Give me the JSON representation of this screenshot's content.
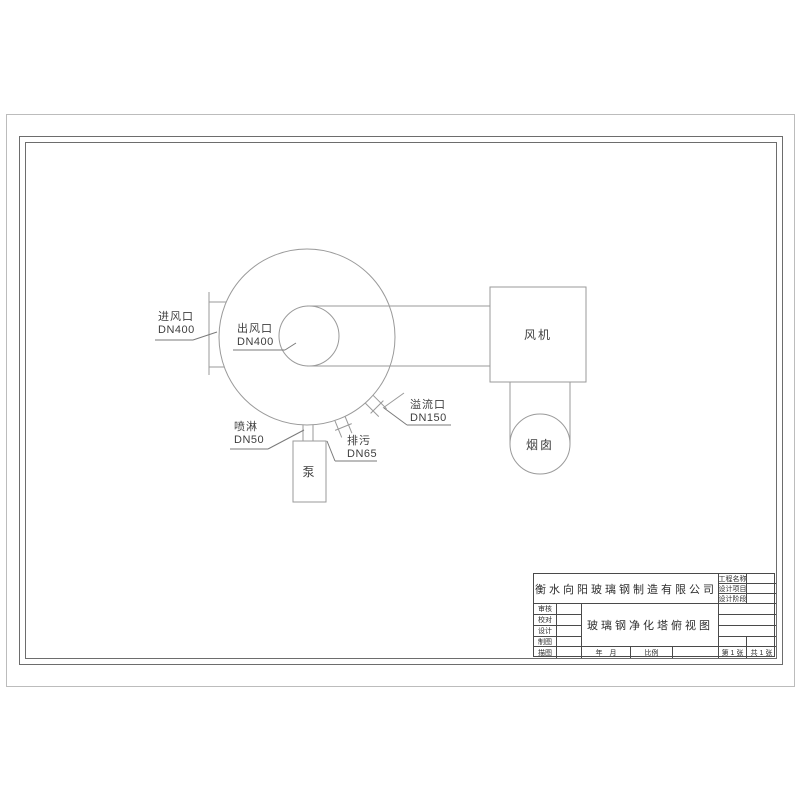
{
  "diagram": {
    "inlet_label": "进风口",
    "inlet_dn": "DN400",
    "outlet_label": "出风口",
    "outlet_dn": "DN400",
    "spray_label": "喷淋",
    "spray_dn": "DN50",
    "drain_label": "排污",
    "drain_dn": "DN65",
    "overflow_label": "溢流口",
    "overflow_dn": "DN150",
    "pump_label": "泵",
    "fan_label": "风机",
    "chimney_label": "烟囱"
  },
  "title_block": {
    "company": "衡水向阳玻璃钢制造有限公司",
    "drawing_title": "玻璃钢净化塔俯视图",
    "project_name_label": "工程名称",
    "design_project_label": "设计项目",
    "design_stage_label": "设计阶段",
    "review_label": "审核",
    "proofread_label": "校对",
    "design_label": "设计",
    "drafting_label": "制图",
    "tracing_label": "描图",
    "date_label": "年　月",
    "scale_label": "比例",
    "sheet_no_label": "第 1 张",
    "sheet_total_label": "共 1 张"
  },
  "colors": {
    "drawing_line": "#9a9a9a",
    "leader_line": "#7a7a7a",
    "frame_line": "#6d6d6d",
    "title_block_line": "#4a4a4a",
    "text": "#3a3a3a",
    "paper": "#ffffff"
  }
}
